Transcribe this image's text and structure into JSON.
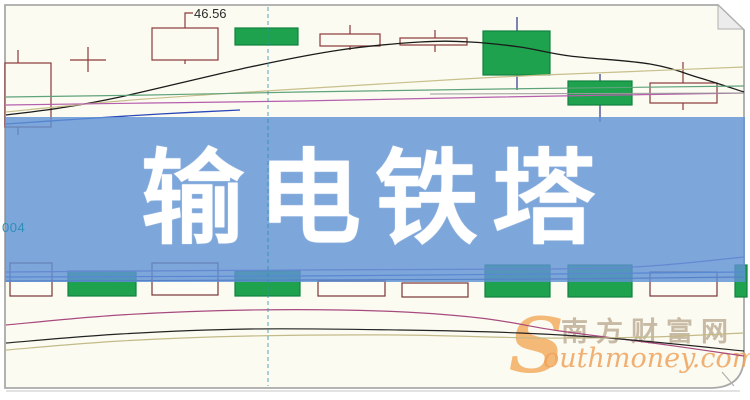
{
  "banner": {
    "title": "输电铁塔",
    "background_color": "rgba(96,146,212,0.82)",
    "text_color": "#ffffff"
  },
  "annotations": {
    "price_label": "46.56",
    "axis_fragment": "004"
  },
  "watermark": {
    "initial": "S",
    "site_cn": "南方财富网",
    "site_en": "outhmoney.com",
    "initial_color": "#f2a24d",
    "cn_color": "#c2b29b",
    "en_color": "#eea25d"
  },
  "chart_data": {
    "type": "candlestick",
    "title": "",
    "note": "No axis scale visible; only price callout 46.56 shown. Coordinates are screenshot pixel positions (750x400). dir=up is hollow red candle, dir=down is filled green candle.",
    "visible_price_label": 46.56,
    "colors": {
      "background": "#fbfbf1",
      "frame": "#a9a9a9",
      "up_fill": "#fbfbf1",
      "up_border": "#8c3a3a",
      "down_fill": "#1ea24d",
      "down_border": "#128240",
      "down_wick": "#27348f",
      "hollow_vol_border": "#793535",
      "dashed_line": "#2e8fae"
    },
    "candles": [
      {
        "x": 5,
        "w": 46,
        "top": 63,
        "bottom": 127,
        "wx": 18,
        "wt": 50,
        "wb": 135,
        "dir": "up"
      },
      {
        "x": 152,
        "w": 66,
        "top": 28,
        "bottom": 60,
        "wx": 185,
        "wt": 27,
        "wb": 64,
        "dir": "up"
      },
      {
        "x": 235,
        "w": 63,
        "top": 28,
        "bottom": 45,
        "wx": 266,
        "wt": 28,
        "wb": 45,
        "dir": "down"
      },
      {
        "x": 320,
        "w": 60,
        "top": 34,
        "bottom": 46,
        "wx": 350,
        "wt": 25,
        "wb": 50,
        "dir": "up"
      },
      {
        "x": 400,
        "w": 67,
        "top": 38,
        "bottom": 45,
        "wx": 435,
        "wt": 30,
        "wb": 52,
        "dir": "up"
      },
      {
        "x": 483,
        "w": 67,
        "top": 31,
        "bottom": 75,
        "wx": 517,
        "wt": 17,
        "wb": 90,
        "dir": "down"
      },
      {
        "x": 568,
        "w": 64,
        "top": 81,
        "bottom": 105,
        "wx": 600,
        "wt": 74,
        "wb": 122,
        "dir": "down"
      },
      {
        "x": 650,
        "w": 67,
        "top": 83,
        "bottom": 103,
        "wx": 683,
        "wt": 62,
        "wb": 110,
        "dir": "up"
      }
    ],
    "doji": {
      "cx": 88,
      "y": 60,
      "half": 18,
      "wt": 47,
      "wb": 72
    },
    "volume_bars": [
      {
        "x": 10,
        "w": 42,
        "top": 263,
        "bottom": 296,
        "kind": "hollow"
      },
      {
        "x": 68,
        "w": 68,
        "top": 271,
        "bottom": 296,
        "kind": "green"
      },
      {
        "x": 152,
        "w": 66,
        "top": 263,
        "bottom": 295,
        "kind": "hollow"
      },
      {
        "x": 235,
        "w": 65,
        "top": 271,
        "bottom": 296,
        "kind": "green"
      },
      {
        "x": 318,
        "w": 67,
        "top": 281,
        "bottom": 296,
        "kind": "hollow"
      },
      {
        "x": 402,
        "w": 66,
        "top": 283,
        "bottom": 297,
        "kind": "hollow"
      },
      {
        "x": 485,
        "w": 65,
        "top": 265,
        "bottom": 297,
        "kind": "green"
      },
      {
        "x": 568,
        "w": 64,
        "top": 265,
        "bottom": 297,
        "kind": "green"
      },
      {
        "x": 650,
        "w": 67,
        "top": 272,
        "bottom": 296,
        "kind": "hollow"
      },
      {
        "x": 735,
        "w": 12,
        "top": 265,
        "bottom": 297,
        "kind": "green"
      }
    ],
    "lines": {
      "top_pane": [
        {
          "name": "ma-black",
          "color": "#1b1b1b",
          "w": 1.3,
          "smooth": true,
          "pts": [
            [
              6,
              115
            ],
            [
              60,
              108
            ],
            [
              120,
              97
            ],
            [
              250,
              67
            ],
            [
              340,
              50
            ],
            [
              420,
              42
            ],
            [
              470,
              42
            ],
            [
              520,
              47
            ],
            [
              570,
              56
            ],
            [
              650,
              64
            ],
            [
              700,
              78
            ],
            [
              744,
              92
            ]
          ]
        },
        {
          "name": "ma-tan",
          "color": "#c8bf8c",
          "w": 1.2,
          "smooth": true,
          "pts": [
            [
              6,
              112
            ],
            [
              120,
              101
            ],
            [
              250,
              92
            ],
            [
              380,
              84
            ],
            [
              500,
              77
            ],
            [
              620,
              72
            ],
            [
              744,
              67
            ]
          ]
        },
        {
          "name": "ma-green",
          "color": "#5fa37b",
          "w": 1.2,
          "smooth": true,
          "pts": [
            [
              6,
              97
            ],
            [
              150,
              95
            ],
            [
              300,
              92
            ],
            [
              500,
              89
            ],
            [
              744,
              86
            ]
          ]
        },
        {
          "name": "ma-magenta",
          "color": "#b55fae",
          "w": 1.2,
          "smooth": true,
          "pts": [
            [
              6,
              105
            ],
            [
              150,
              103
            ],
            [
              300,
              101
            ],
            [
              500,
              97
            ],
            [
              744,
              93
            ]
          ]
        },
        {
          "name": "ma-blue",
          "color": "#2947b8",
          "w": 1.3,
          "smooth": true,
          "pts": [
            [
              6,
              124
            ],
            [
              80,
              119
            ],
            [
              160,
              114
            ],
            [
              240,
              110
            ]
          ]
        },
        {
          "name": "level-gray",
          "color": "#9a9a9a",
          "w": 1.0,
          "smooth": false,
          "pts": [
            [
              430,
              94
            ],
            [
              744,
              93
            ]
          ]
        }
      ],
      "volume_pane": [
        {
          "name": "vol-purple",
          "color": "#7c58c8",
          "w": 1.2,
          "smooth": true,
          "pts": [
            [
              6,
              272
            ],
            [
              300,
              270
            ],
            [
              550,
              269
            ],
            [
              650,
              266
            ],
            [
              744,
              257
            ]
          ]
        },
        {
          "name": "vol-blue",
          "color": "#3a55cc",
          "w": 1.2,
          "smooth": true,
          "pts": [
            [
              6,
              277
            ],
            [
              300,
              276
            ],
            [
              550,
              274
            ],
            [
              744,
              272
            ]
          ]
        },
        {
          "name": "vol-navy",
          "color": "#27348f",
          "w": 1.2,
          "smooth": true,
          "pts": [
            [
              6,
              281
            ],
            [
              300,
              280
            ],
            [
              550,
              279
            ],
            [
              744,
              277
            ]
          ]
        }
      ],
      "macd_pane": [
        {
          "name": "macd-magenta",
          "color": "#a84a7e",
          "w": 1.2,
          "smooth": true,
          "pts": [
            [
              6,
              325
            ],
            [
              120,
              315
            ],
            [
              250,
              310
            ],
            [
              380,
              311
            ],
            [
              480,
              318
            ],
            [
              560,
              331
            ],
            [
              660,
              344
            ],
            [
              744,
              356
            ]
          ]
        },
        {
          "name": "macd-black",
          "color": "#232323",
          "w": 1.2,
          "smooth": true,
          "pts": [
            [
              6,
              343
            ],
            [
              120,
              334
            ],
            [
              250,
              329
            ],
            [
              400,
              330
            ],
            [
              520,
              333
            ],
            [
              620,
              339
            ],
            [
              744,
              351
            ]
          ]
        },
        {
          "name": "macd-tan",
          "color": "#c3ba89",
          "w": 1.2,
          "smooth": true,
          "pts": [
            [
              6,
              350
            ],
            [
              120,
              341
            ],
            [
              250,
              336
            ],
            [
              400,
              335
            ],
            [
              540,
              338
            ],
            [
              650,
              337
            ],
            [
              744,
              333
            ]
          ]
        }
      ]
    },
    "dashed_vline": {
      "x": 268,
      "y1": 7,
      "y2": 386
    }
  }
}
